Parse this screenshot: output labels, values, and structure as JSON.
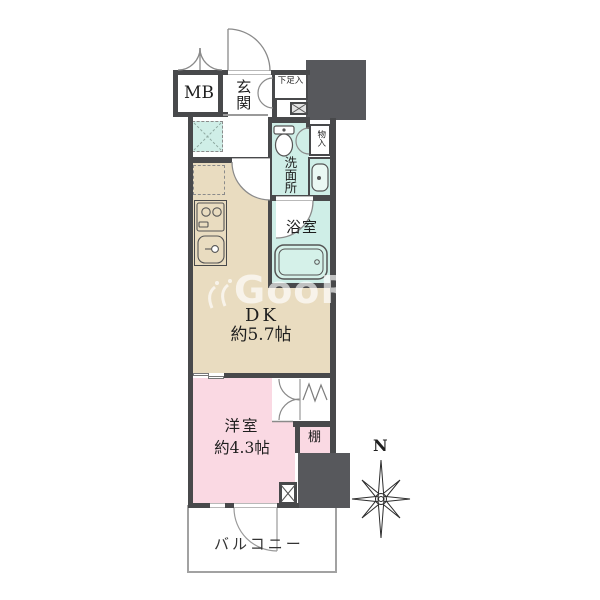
{
  "title": "apartment-floorplan",
  "watermark": {
    "text": "GooRoom"
  },
  "compass": {
    "north_label": "N"
  },
  "rooms": {
    "meter_box": {
      "label": "MB"
    },
    "entrance": {
      "label": "玄関"
    },
    "shoe_cabinet": {
      "label": "下足入"
    },
    "small_closet": {
      "label": "物入"
    },
    "washroom": {
      "label": "洗面所"
    },
    "bathroom": {
      "label": "浴室"
    },
    "dining_kitchen": {
      "label": "DK",
      "size": "約5.7帖"
    },
    "western_room": {
      "label": "洋室",
      "size": "約4.3帖"
    },
    "shelf": {
      "label": "棚"
    },
    "balcony": {
      "label": "バルコニー"
    }
  },
  "fixtures": {
    "toilet": "toilet-icon",
    "wash_basin": "wash-basin-icon",
    "bathtub": "bathtub-icon",
    "stove": "stove-icon",
    "kitchen_sink": "kitchen-sink-icon",
    "washer_space": "washer-space-icon",
    "fridge_space": "fridge-space-icon",
    "hanger_pipe": "hanger-pipe-icon",
    "pipe_space": "pipe-space-icon",
    "compass": "compass-rose-icon"
  },
  "colors": {
    "wall": "#48494b",
    "pillar": "#57585c",
    "dk_floor": "#e9dcc0",
    "western_floor": "#fad9e3",
    "wet_area": "#cfeee7",
    "balcony_border": "#a2a2a2",
    "background": "#ffffff"
  }
}
